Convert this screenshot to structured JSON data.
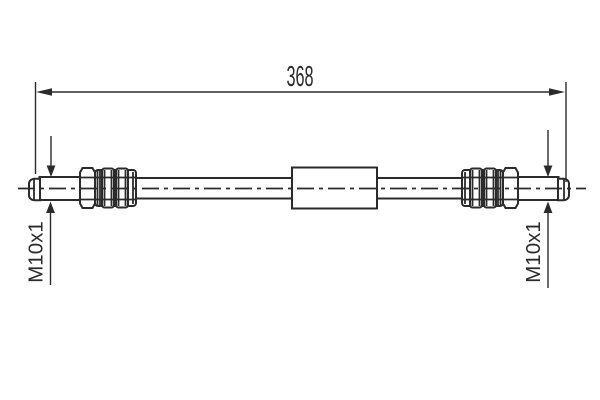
{
  "colors": {
    "line": "#2b2b2b",
    "background": "#ffffff"
  },
  "dimension": {
    "label": "368"
  },
  "thread_left": {
    "label": "M10x1"
  },
  "thread_right": {
    "label": "M10x1"
  }
}
